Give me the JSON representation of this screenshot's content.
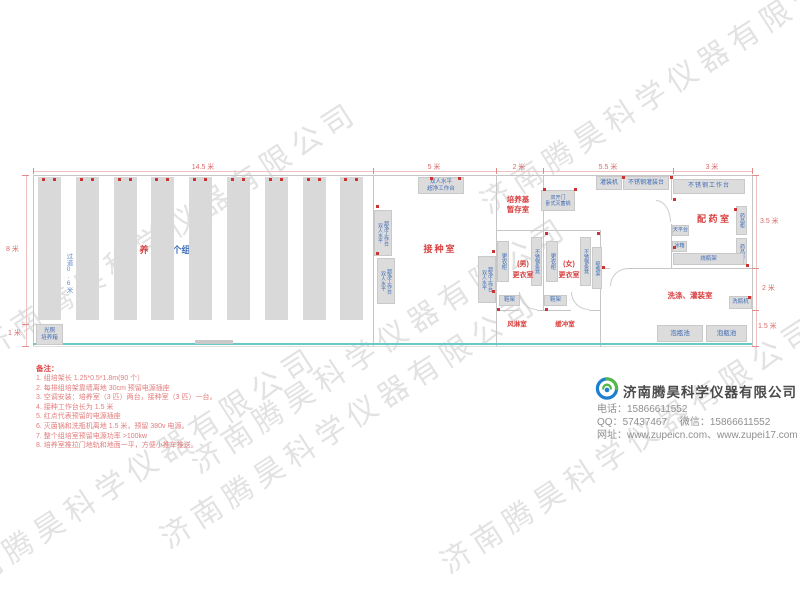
{
  "watermark": {
    "text": "济南腾昊科学仪器有限公司"
  },
  "colors": {
    "red_label": "#d84040",
    "blue_label": "#3f6cb5",
    "teal_track": "#68c9cb",
    "note_red": "#e27d7d",
    "logo_blue": "#1d7fd0",
    "logo_green": "#52b848"
  },
  "plan": {
    "dims": {
      "top": [
        {
          "label": "14.5 米"
        },
        {
          "label": "5 米"
        },
        {
          "label": "2 米"
        },
        {
          "label": "5.5 米"
        },
        {
          "label": "3 米"
        }
      ],
      "left": [
        {
          "label": "8 米"
        },
        {
          "label": "1 米"
        }
      ],
      "right": [
        {
          "label": "3.5 米"
        },
        {
          "label": "2 米"
        },
        {
          "label": "1.5 米"
        }
      ]
    },
    "culture_room": {
      "room_label": "培 养 室",
      "racks_label": "90个组培架",
      "rack_count": 9,
      "aisle_label": "过道0.6米",
      "incubator_line1": "光照",
      "incubator_line2": "培养箱"
    },
    "inoculation_room": {
      "room_label": "接种室",
      "bench_line1": "双人水平",
      "bench_line2": "超净工作台"
    },
    "media_room": {
      "label_line1": "培养基",
      "label_line2": "暂存室",
      "sterilizer_line1": "双开门",
      "sterilizer_line2": "卧式灭菌锅"
    },
    "changing_area": {
      "male_tag": "(男)",
      "male_room": "更衣室",
      "female_tag": "(女)",
      "female_room": "更衣室",
      "wardrobe": "更衣柜",
      "bench": "不锈钢条凳",
      "bottle_rack": "晾瓶架",
      "shoe_rack": "鞋架",
      "air_shower": "风淋室",
      "buffer_room": "缓冲室"
    },
    "right_wing": {
      "filling_machine": "灌装机",
      "filling_table": "不锈钢灌装台",
      "workbench": "不锈钢工作台",
      "pharmacy_room": "配 药 室",
      "medicine_cabinet": "药品柜",
      "balance_table": "天平台",
      "fridge": "冰箱",
      "flask_rack": "烧瓶架",
      "washing_room": "洗涤、灌装室",
      "bottle_washer": "洗瓶机",
      "soak_pool": "泡瓶池"
    },
    "power_dots": [
      [
        376,
        205
      ],
      [
        376,
        252
      ],
      [
        430,
        177
      ],
      [
        458,
        177
      ],
      [
        492,
        250
      ],
      [
        492,
        290
      ],
      [
        543,
        188
      ],
      [
        574,
        188
      ],
      [
        545,
        232
      ],
      [
        597,
        232
      ],
      [
        602,
        266
      ],
      [
        622,
        176
      ],
      [
        670,
        176
      ],
      [
        673,
        198
      ],
      [
        673,
        246
      ],
      [
        734,
        208
      ],
      [
        746,
        264
      ],
      [
        748,
        296
      ],
      [
        545,
        308
      ],
      [
        497,
        308
      ]
    ]
  },
  "notes": {
    "title": "备注：",
    "items": [
      "1. 组培架长 1.25*0.5*1.8m(90 个）",
      "2. 每排组培架靠墙离地 30cm 预留电源插座",
      "3. 空调安装：培养室（3 匹）两台，接种室（3 匹）一台。",
      "4. 接种工作台长为 1.5 米",
      "5. 红点代表预留的电源插座",
      "6. 灭菌锅和洗瓶机离地 1.5 米，预留 380v 电源。",
      "7. 整个组培室预留电源功率 >100kw",
      "8. 培养室推拉门地轨和地面一平，方便小推车推送。"
    ]
  },
  "company": {
    "name": "济南腾昊科学仪器有限公司",
    "phone_label": "电话：",
    "phone": "15866611552",
    "qq_label": "QQ：",
    "qq": "57437467",
    "wechat_label": "微信：",
    "wechat": "15866611552",
    "web_label": "网址：",
    "web": "www.zupeicn.com、www.zupei17.com"
  }
}
